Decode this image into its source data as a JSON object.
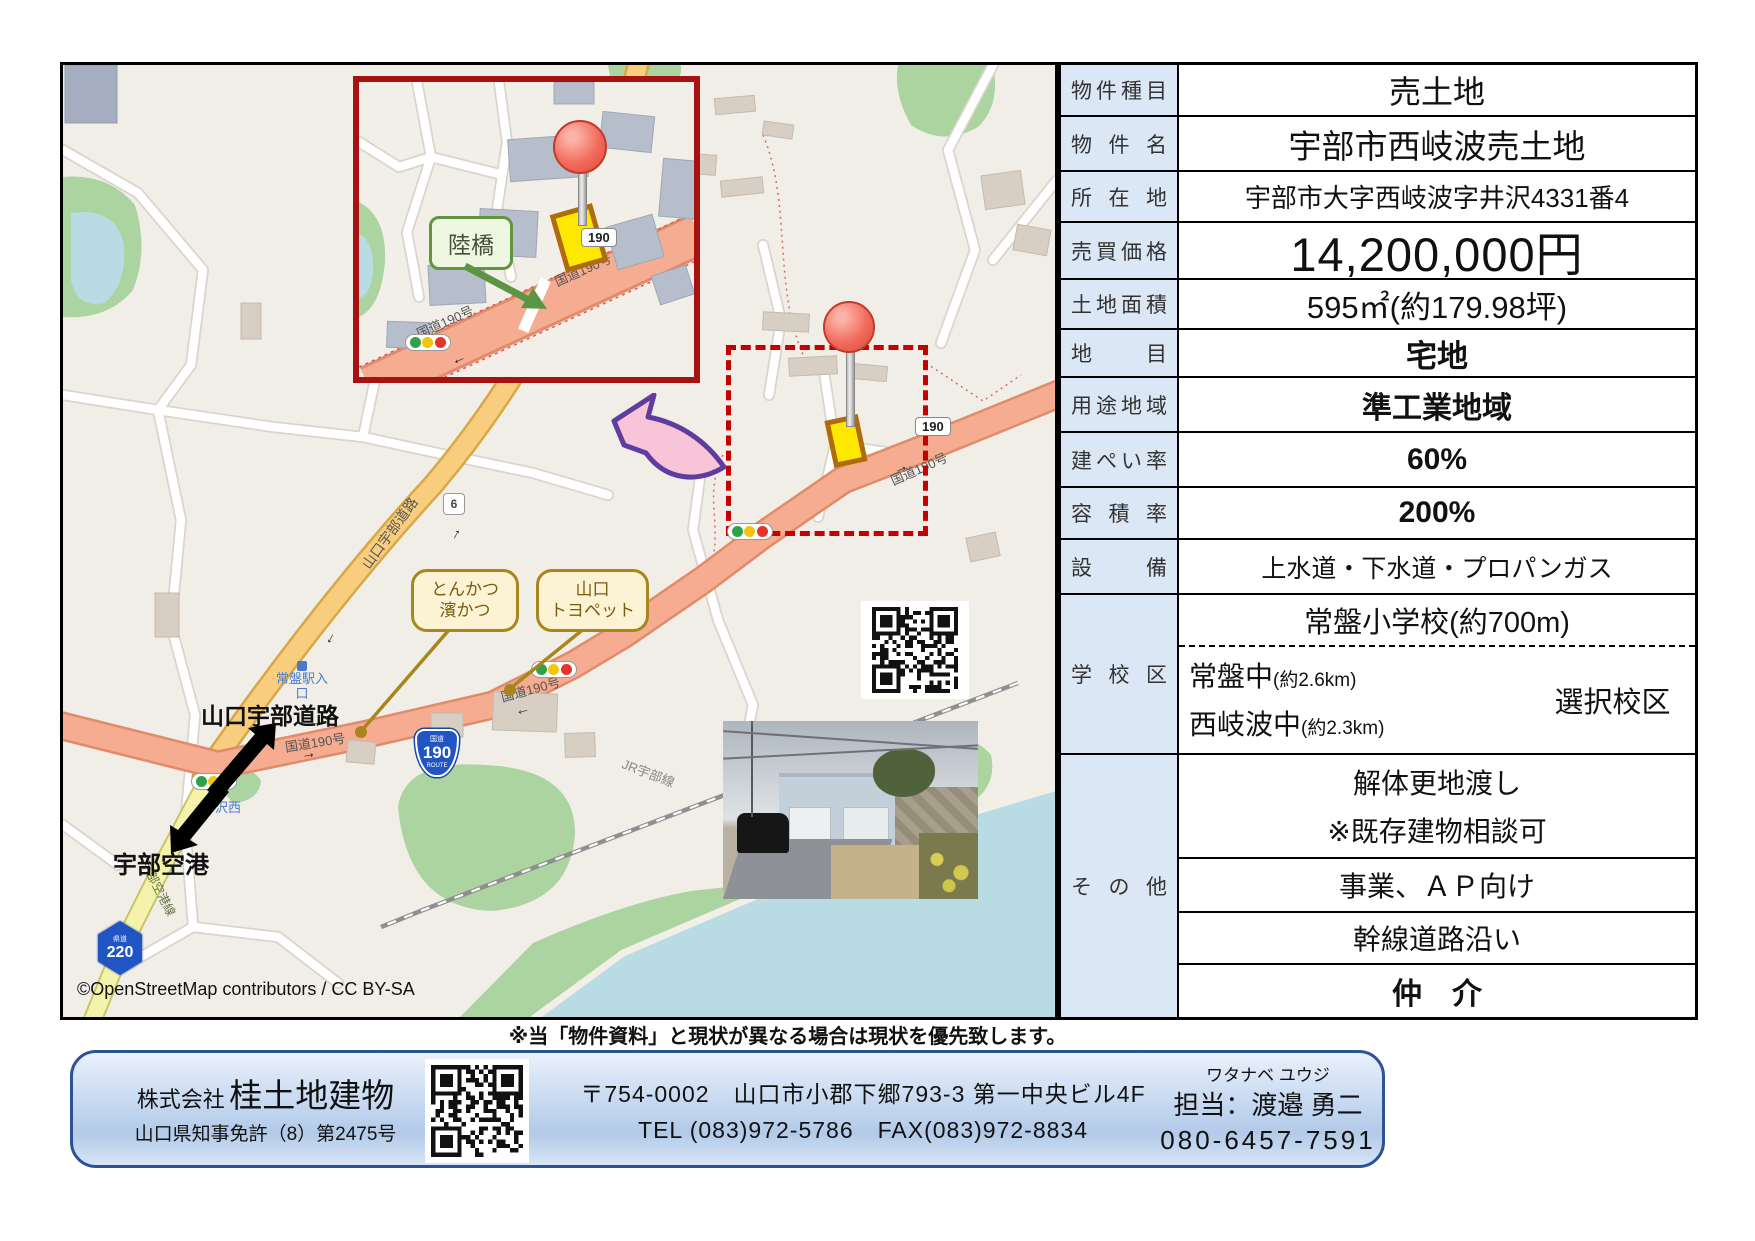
{
  "page": {
    "disclaimer": "※当「物件資料」と現状が異なる場合は現状を優先致します。"
  },
  "map": {
    "attribution": "©OpenStreetMap contributors / CC BY-SA",
    "inset": {
      "overpass_label": "陸橋",
      "shield_190": "190",
      "road_text_upper": "国道190号",
      "road_text_lower": "国道190号"
    },
    "roads": {
      "route190_text_left": "国道190号",
      "route190_text_mid": "国道190号",
      "route190_text_right": "国道190号",
      "yamaguchi_ube_expwy_text": "山口宇部道路",
      "ube_airport_line_text": "宇部空港線",
      "jr_line_text": "JR宇部線"
    },
    "shields": {
      "national_top": "国道",
      "national_num": "190",
      "national_bottom": "ROUTE",
      "white_190": "190",
      "pref_top": "県道",
      "pref_num": "220",
      "route6_num": "6"
    },
    "labels": {
      "yamaguchi_ube_road": "山口宇部道路",
      "ube_airport": "宇部空港",
      "tokiwa_station_line1": "常盤駅入",
      "tokiwa_station_line2": "口",
      "intersection_name": "沢西"
    },
    "bubbles": {
      "tonkatsu_line1": "とんかつ",
      "tonkatsu_line2": "濱かつ",
      "toyopet_line1": "山口",
      "toyopet_line2": "トヨペット"
    }
  },
  "table": {
    "rows": [
      {
        "label": "物件種目",
        "value": "売土地"
      },
      {
        "label": "物件名",
        "value": "宇部市西岐波売土地"
      },
      {
        "label": "所在地",
        "value": "宇部市大字西岐波字井沢4331番4"
      },
      {
        "label": "売買価格",
        "value": "14,200,000円"
      },
      {
        "label": "土地面積",
        "value": "595㎡(約179.98坪)"
      },
      {
        "label": "地目",
        "value": "宅地"
      },
      {
        "label": "用途地域",
        "value": "準工業地域"
      },
      {
        "label": "建ぺい率",
        "value": "60%"
      },
      {
        "label": "容積率",
        "value": "200%"
      },
      {
        "label": "設備",
        "value": "上水道・下水道・プロパンガス"
      }
    ],
    "school": {
      "label": "学校区",
      "elementary": "常盤小学校(約700m)",
      "junior1": "常盤中",
      "junior1_dist": "(約2.6km)",
      "junior2": "西岐波中",
      "junior2_dist": "(約2.3km)",
      "choice": "選択校区"
    },
    "other": {
      "label": "その他",
      "line1a": "解体更地渡し",
      "line1b": "※既存建物相談可",
      "line2": "事業、ＡＰ向け",
      "line3": "幹線道路沿い",
      "line4": "仲　介"
    }
  },
  "footer": {
    "company_prefix": "株式会社",
    "company_name": "桂土地建物",
    "license": "山口県知事免許（8）第2475号",
    "address": "〒754-0002　山口市小郡下郷793-3 第一中央ビル4F",
    "tel_fax": "TEL (083)972-5786　FAX(083)972-8834",
    "agent_kana": "ワタナベ ユウジ",
    "agent_name": "担当：渡邉 勇二",
    "phone": "080-6457-7591"
  }
}
